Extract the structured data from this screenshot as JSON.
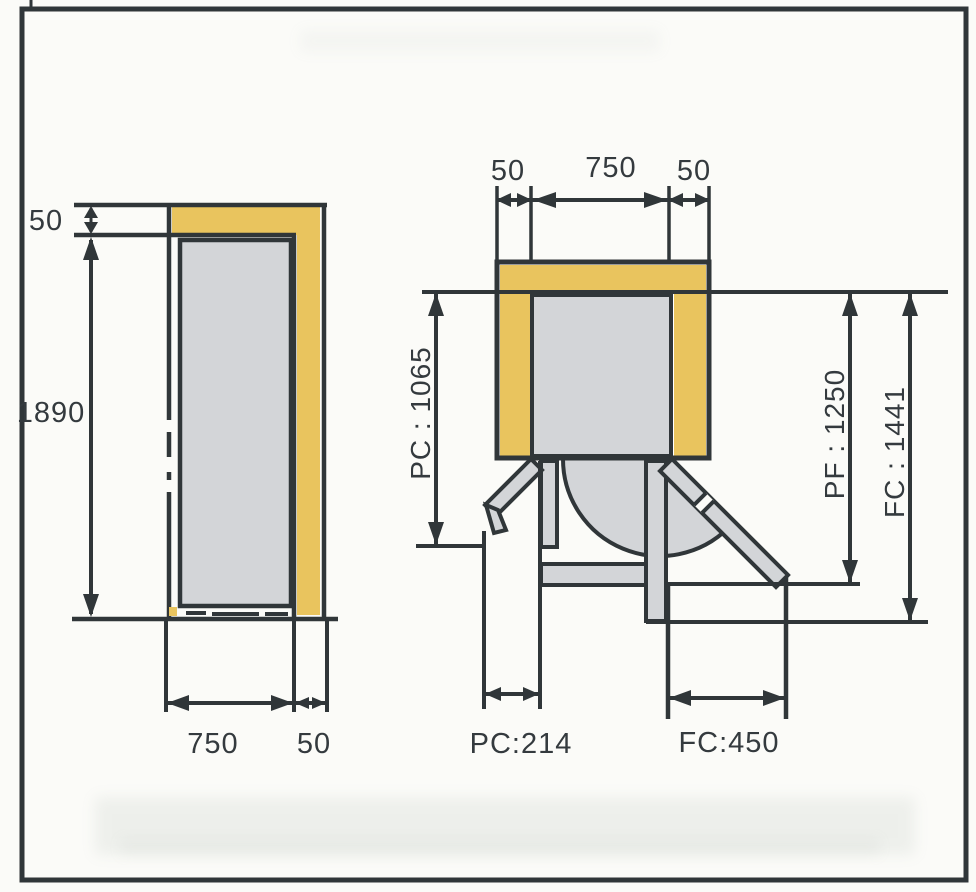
{
  "side_view": {
    "top_clearance_label": "50",
    "height_label": "1890",
    "bottom_width_label": "750",
    "bottom_clearance_label": "50"
  },
  "plan_view": {
    "top_left_clearance_label": "50",
    "top_width_label": "750",
    "top_right_clearance_label": "50",
    "pc_depth_label": "PC : 1065",
    "pf_depth_label": "PF : 1250",
    "fc_depth_label": "FC : 1441",
    "pc_width_label": "PC:214",
    "fc_width_label": "FC:450"
  },
  "colors": {
    "clearance_yellow": "#e9c45e",
    "body_gray": "#d3d5d8",
    "line_dark": "#303639"
  }
}
